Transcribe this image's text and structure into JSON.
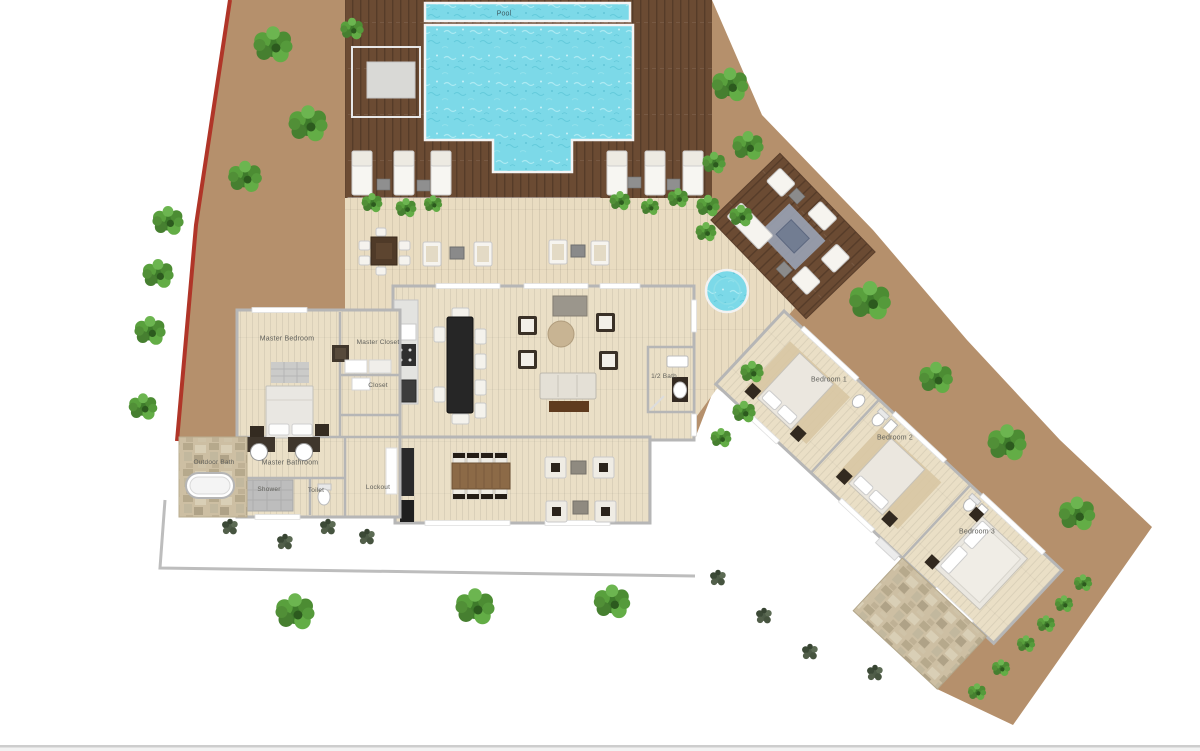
{
  "plan": {
    "title": "Villa floor plan with pool",
    "labels": {
      "pool": "Pool",
      "master_bedroom": "Master Bedroom",
      "master_closet": "Master Closet",
      "closet": "Closet",
      "half_bath": "1/2 Bath",
      "master_bathroom": "Master Bathroom",
      "shower": "Shower",
      "toilet": "Toilet",
      "lockout": "Lockout",
      "outdoor_bath": "Outdoor Bath",
      "bedroom_1": "Bedroom 1",
      "bedroom_2": "Bedroom 2",
      "bedroom_3": "Bedroom 3"
    },
    "palette": {
      "background": "#ffffff",
      "dirt": "#b5906c",
      "deck_wood": "#6b4b33",
      "terrace_wood": "#e9dcc1",
      "interior_wood": "#eadfc6",
      "pool_water": "#7cd9e8",
      "wall_gray": "#b8b8b8",
      "boundary_red": "#b03528",
      "plant_green": "#4e8f37",
      "stone": "#cdbfa3"
    }
  }
}
